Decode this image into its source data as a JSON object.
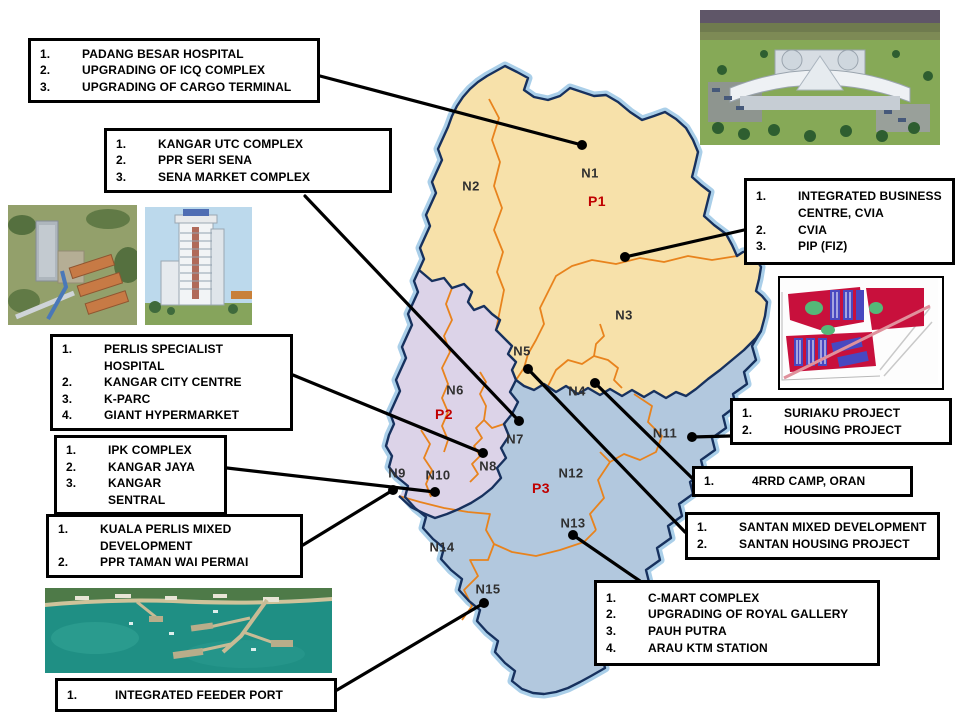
{
  "map": {
    "colors": {
      "region_p1": "#f7e1aa",
      "region_p2": "#dcd3e8",
      "region_p3": "#b2c8de",
      "coast_halo": "#aacfe9",
      "border_navy": "#17315e",
      "district_orange": "#e8831d",
      "zone_label": "#303030",
      "p_label": "#c00000",
      "connector": "#000000",
      "box_border": "#000000"
    },
    "zones": {
      "n1": "N1",
      "n2": "N2",
      "n3": "N3",
      "n4": "N4",
      "n5": "N5",
      "n6": "N6",
      "n7": "N7",
      "n8": "N8",
      "n9": "N9",
      "n10": "N10",
      "n11": "N11",
      "n12": "N12",
      "n13": "N13",
      "n14": "N14",
      "n15": "N15",
      "p1": "P1",
      "p2": "P2",
      "p3": "P3"
    }
  },
  "callouts": {
    "padang_besar": {
      "items": [
        {
          "n": "1.",
          "t": "PADANG BESAR HOSPITAL"
        },
        {
          "n": "2.",
          "t": "UPGRADING OF ICQ COMPLEX"
        },
        {
          "n": "3.",
          "t": "UPGRADING OF CARGO TERMINAL"
        }
      ]
    },
    "kangar_utc": {
      "items": [
        {
          "n": "1.",
          "t": "KANGAR UTC COMPLEX"
        },
        {
          "n": "2.",
          "t": "PPR SERI SENA"
        },
        {
          "n": "3.",
          "t": "SENA MARKET COMPLEX"
        }
      ]
    },
    "integrated_business": {
      "items": [
        {
          "n": "1.",
          "t": "INTEGRATED BUSINESS CENTRE, CVIA"
        },
        {
          "n": "2.",
          "t": "CVIA"
        },
        {
          "n": "3.",
          "t": "PIP (FIZ)"
        }
      ]
    },
    "perlis_specialist": {
      "items": [
        {
          "n": "1.",
          "t": "PERLIS SPECIALIST HOSPITAL"
        },
        {
          "n": "2.",
          "t": "KANGAR CITY CENTRE"
        },
        {
          "n": "3.",
          "t": "K-PARC"
        },
        {
          "n": "4.",
          "t": "GIANT HYPERMARKET"
        }
      ]
    },
    "ipk": {
      "items": [
        {
          "n": "1.",
          "t": "IPK COMPLEX"
        },
        {
          "n": "2.",
          "t": "KANGAR JAYA"
        },
        {
          "n": "3.",
          "t": "KANGAR SENTRAL"
        }
      ]
    },
    "kuala_perlis": {
      "items": [
        {
          "n": "1.",
          "t": "KUALA PERLIS MIXED DEVELOPMENT"
        },
        {
          "n": "2.",
          "t": "PPR TAMAN WAI PERMAI"
        }
      ]
    },
    "suriaku": {
      "items": [
        {
          "n": "1.",
          "t": "SURIAKU PROJECT"
        },
        {
          "n": "2.",
          "t": "HOUSING PROJECT"
        }
      ]
    },
    "rrd_camp": {
      "items": [
        {
          "n": "1.",
          "t": "4RRD CAMP, ORAN"
        }
      ]
    },
    "santan": {
      "items": [
        {
          "n": "1.",
          "t": "SANTAN MIXED DEVELOPMENT"
        },
        {
          "n": "2.",
          "t": "SANTAN HOUSING PROJECT"
        }
      ]
    },
    "cmart": {
      "items": [
        {
          "n": "1.",
          "t": "C-MART COMPLEX"
        },
        {
          "n": "2.",
          "t": "UPGRADING OF ROYAL GALLERY"
        },
        {
          "n": "3.",
          "t": "PAUH PUTRA"
        },
        {
          "n": "4.",
          "t": "ARAU KTM STATION"
        }
      ]
    },
    "feeder_port": {
      "items": [
        {
          "n": "1.",
          "t": "INTEGRATED FEEDER PORT"
        }
      ]
    }
  }
}
